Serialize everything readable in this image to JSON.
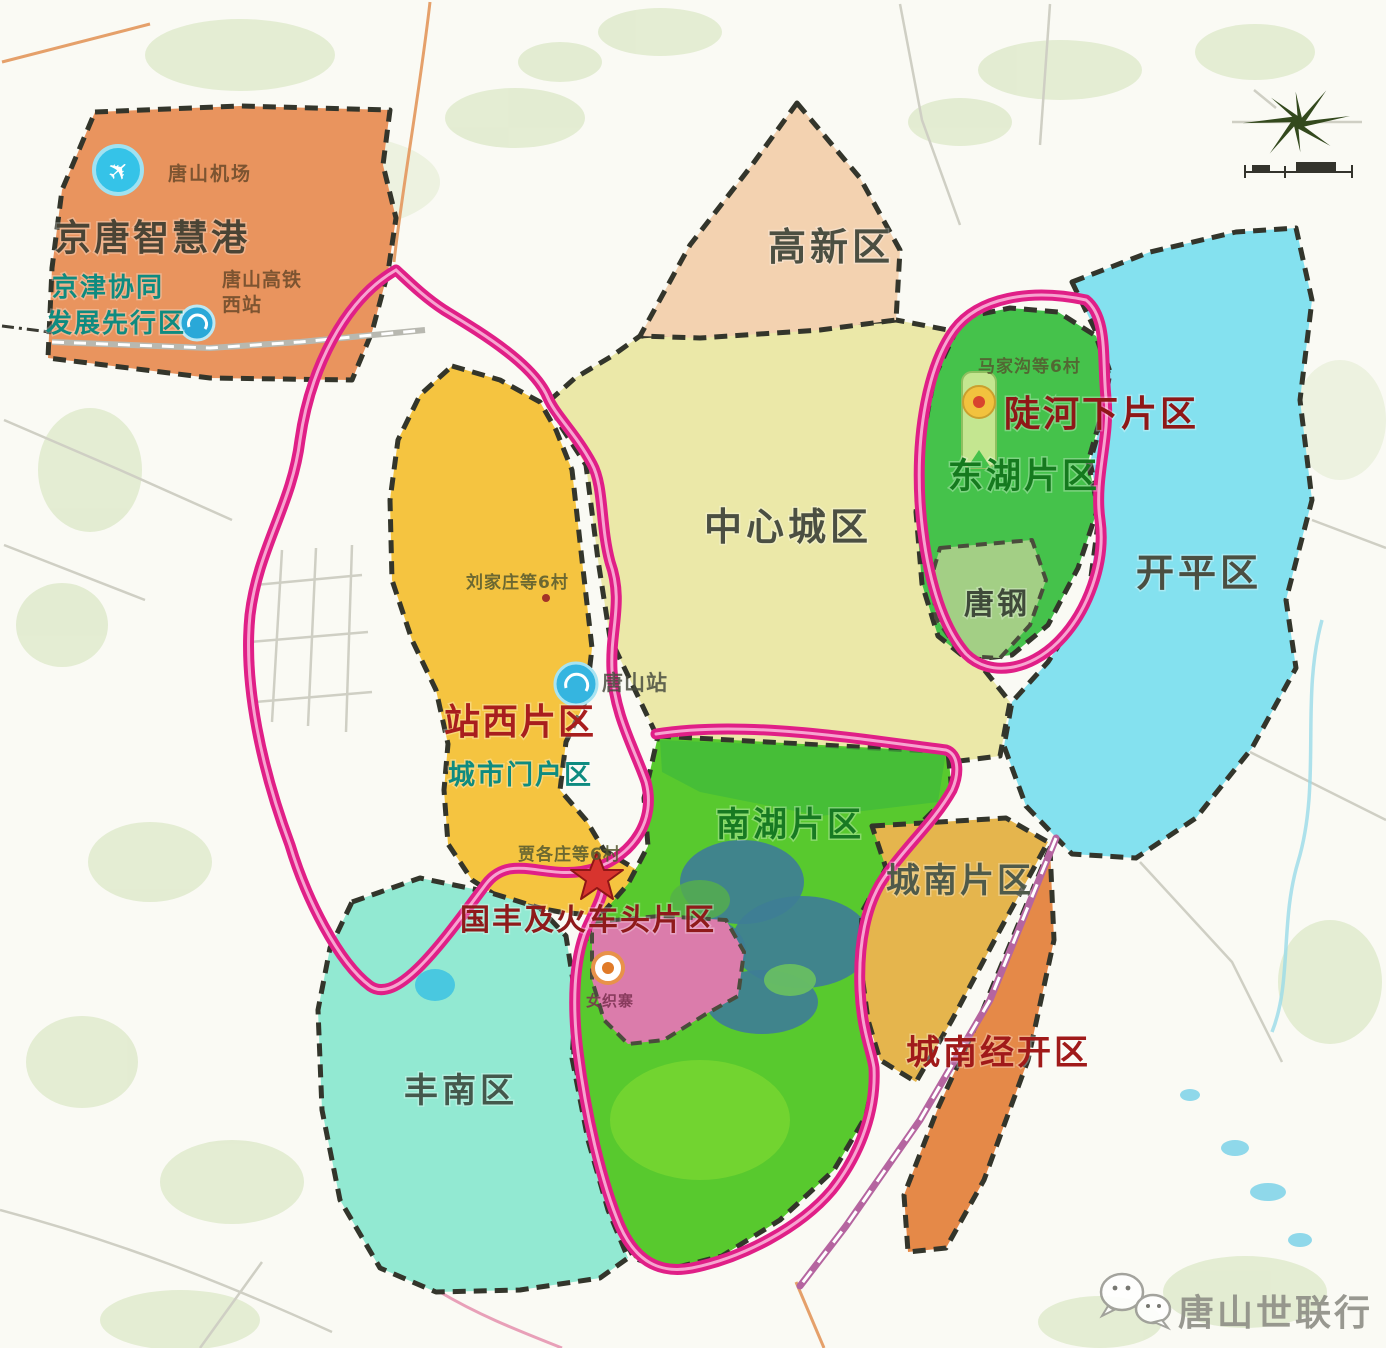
{
  "regions": {
    "jingtang": {
      "label": "京唐智慧港",
      "color": "#e9945e"
    },
    "gaoxin": {
      "label": "高新区",
      "color": "#f3d2b0"
    },
    "center": {
      "label": "中心城区",
      "color": "#ebe8a8"
    },
    "donghu": {
      "label": "东湖片区",
      "color": "#45c24b"
    },
    "tanggang": {
      "label": "唐钢",
      "color": "#a3cf85"
    },
    "kaiping": {
      "label": "开平区",
      "color": "#84e1ef"
    },
    "zhanxi": {
      "label": "站西片区",
      "color": "#f5c440"
    },
    "nanhu": {
      "label": "南湖片区",
      "color": "#58c92e"
    },
    "chengnan": {
      "label": "城南片区",
      "color": "#e5b54d"
    },
    "jingkai": {
      "label": "城南经开区",
      "color": "#e58948"
    },
    "fengnan": {
      "label": "丰南区",
      "color": "#92e9d2"
    },
    "pinkzone": {
      "label": "女织寨",
      "color": "#db7cab"
    }
  },
  "labels": {
    "jingtang_sub1": "京津协同",
    "jingtang_sub2": "发展先行区",
    "airport": "唐山机场",
    "hsr_line1": "唐山高铁",
    "hsr_line2": "西站",
    "donghu_red": "陡河下片区",
    "zhanxi_sub": "城市门户区",
    "station": "唐山站",
    "guofeng": "国丰及火车头片区",
    "village_zhanxi": "刘家庄等6村",
    "village_star": "贾各庄等6村",
    "village_donghu": "马家沟等6村",
    "watermark": "唐山世联行"
  },
  "colors": {
    "ring_magenta": "#e01f87",
    "border_dash": "#33352b",
    "label_dark": "#4b4f42",
    "label_red": "#a01a1a",
    "label_teal": "#0e8b80",
    "label_green": "#177a22",
    "background": "#fafaf4"
  }
}
